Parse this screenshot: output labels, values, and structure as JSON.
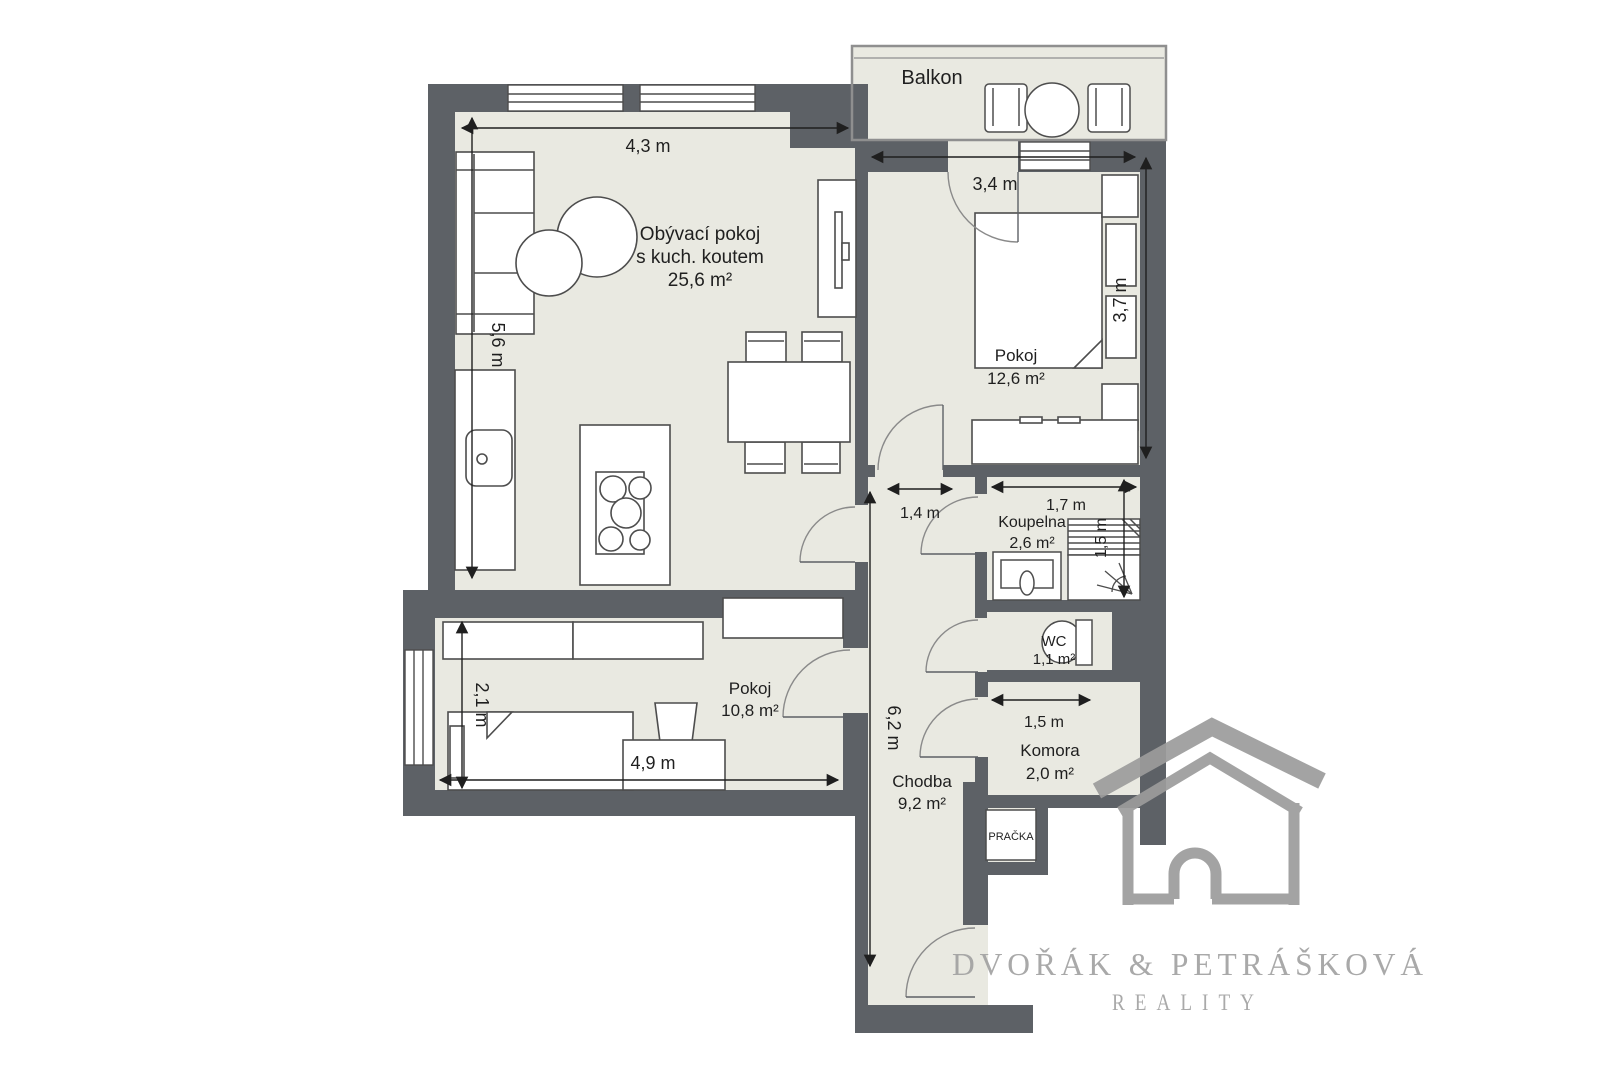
{
  "plan": {
    "balcony": {
      "label": "Balkon"
    },
    "living_room": {
      "line1": "Obývací pokoj",
      "line2": "s kuch. koutem",
      "area": "25,6 m²",
      "dim_width": "4,3 m",
      "dim_height": "5,6 m"
    },
    "bedroom": {
      "label": "Pokoj",
      "area": "12,6 m²",
      "dim_width": "3,4 m",
      "dim_height": "3,7 m"
    },
    "bathroom": {
      "label": "Koupelna",
      "area": "2,6 m²",
      "dim_width": "1,7 m",
      "dim_height": "1,5 m"
    },
    "wc": {
      "label": "WC",
      "area": "1,1 m²"
    },
    "storage": {
      "label": "Komora",
      "area": "2,0 m²",
      "dim_width": "1,5 m"
    },
    "room2": {
      "label": "Pokoj",
      "area": "10,8 m²",
      "dim_width": "4,9 m",
      "dim_height": "2,1 m"
    },
    "hallway": {
      "label": "Chodba",
      "area": "9,2 m²",
      "dim_length": "6,2 m",
      "dim_entry": "1,4 m"
    },
    "washer": {
      "label": "PRAČKA"
    }
  },
  "branding": {
    "name": "DVOŘÁK & PETRÁŠKOVÁ",
    "tagline": "REALITY"
  },
  "colors": {
    "wall": "#5d6166",
    "floor": "#e9e9e1",
    "logo": "#9c9c9c"
  }
}
